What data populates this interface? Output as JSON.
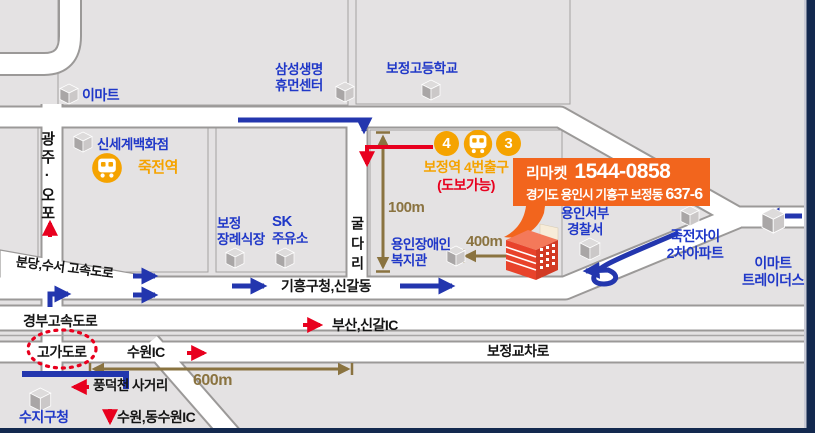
{
  "colors": {
    "background": "#E4E2E3",
    "road_fill": "#FFFFFF",
    "road_casing": "#9B9998",
    "blue_text": "#2038C8",
    "black_text": "#141414",
    "orange_text": "#F5A300",
    "red_accent": "#E8001E",
    "olive_distance": "#8A7340",
    "route_blue": "#2336AE",
    "callout_bg": "#F2651D",
    "station_badge": "#F5A300",
    "navy_border": "#13294F"
  },
  "labels": {
    "emart": "이마트",
    "samsung_life": [
      "삼성생명",
      "휴먼센터"
    ],
    "bojeong_high_school": "보정고등학교",
    "gwangju_opo": "광주·오포",
    "shinsegae": "신세계백화점",
    "jukjeon_station": "죽전역",
    "bojeong_funeral": [
      "보정",
      "장례식장"
    ],
    "sk_gas": [
      "SK",
      "주유소"
    ],
    "guldari": "굴다리",
    "bojeong_exit": "보정역 4번출구",
    "walkable": "(도보가능)",
    "dist_100m": "100m",
    "yongin_welfare": [
      "용인장애인",
      "복지관"
    ],
    "dist_400m": "400m",
    "police": [
      "용인서부",
      "경찰서"
    ],
    "jukjeon_xi": [
      "죽전자이",
      "2차아파트"
    ],
    "emart_traders": [
      "이마트",
      "트레이더스"
    ],
    "giheung_singal": "기흥구청,신갈동",
    "bundang_suseo": "분당,수서 고속도로",
    "gyeongbu_expwy": "경부고속도로",
    "busan_singal_ic": "부산,신갈IC",
    "overpass": "고가도로",
    "suwon_ic": "수원IC",
    "bojeong_crossing": "보정교차로",
    "dist_600m": "600m",
    "pungdeokcheon": "풍덕천 사거리",
    "suji_office": "수지구청",
    "suwon_dongsuwon_ic": "수원,동수원IC",
    "exit_no_4": "4",
    "exit_no_3": "3"
  },
  "callout": {
    "name": "리마켓",
    "phone": "1544-0858",
    "address1": "경기도 용인시 기흥구 보정동",
    "address2": "637-6"
  }
}
